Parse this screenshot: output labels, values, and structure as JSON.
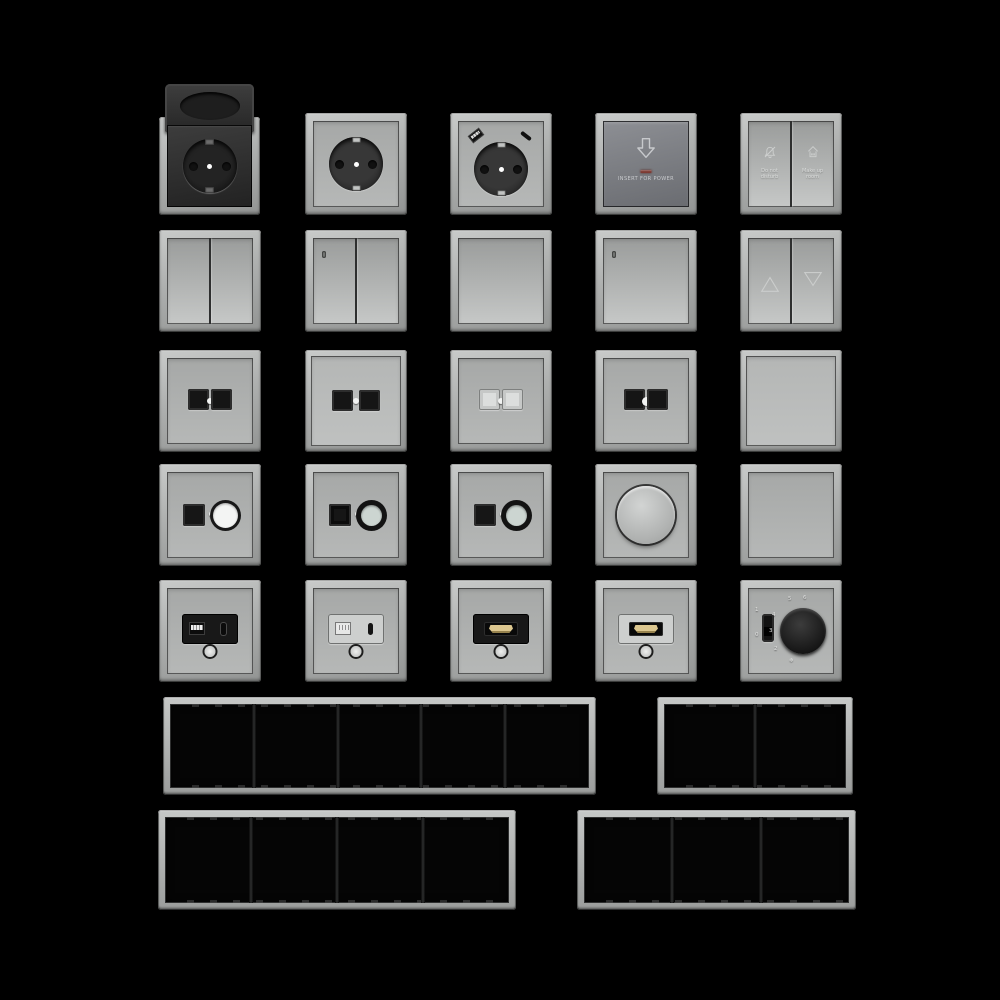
{
  "page": {
    "background": "#000000",
    "description": "Product sheet of modular wall switches, sockets and cover frames rendered on black"
  },
  "palette": {
    "frame_gray": "#b0b2b1",
    "plate_gray": "#aeb0af",
    "dark_plate": "#74767b",
    "insert_black": "#1a1a1a",
    "hdmi_gold": "#dcc78f",
    "led_red": "#7d3a33",
    "center_dot": "#ffffff"
  },
  "grid": {
    "rows": [
      {
        "items": [
          "schuko-socket-hinged-cover-black",
          "schuko-socket-gray",
          "schuko-socket-usb-charger",
          "keycard-power-switch",
          "hotel-service-double-switch"
        ]
      },
      {
        "items": [
          "double-rocker-switch",
          "double-rocker-switch-led",
          "single-rocker-switch",
          "single-rocker-switch-led",
          "blind-control-switch"
        ]
      },
      {
        "items": [
          "dual-data-socket-black",
          "dual-data-socket-black-raised",
          "dual-data-socket-white",
          "dual-data-socket-black-indicator",
          "blank-rocker-plate"
        ]
      },
      {
        "items": [
          "data-coax-combo-white-ring",
          "data-coax-combo-black-ring",
          "data-coax-combo-black-ring-2",
          "rotary-dimmer",
          "blank-cover-plate"
        ]
      },
      {
        "items": [
          "usb-a-c-charger-black",
          "usb-a-c-charger-gray",
          "hdmi-socket-black",
          "hdmi-socket-gray",
          "thermostat-dial"
        ]
      }
    ]
  },
  "keycard_switch": {
    "icon": "arrow-down-outline",
    "label": "INSERT FOR POWER",
    "led_color": "#7d3a33"
  },
  "hotel_switch": {
    "left": {
      "icon": "do-not-disturb-bell",
      "label_line1": "Do not",
      "label_line2": "disturb"
    },
    "right": {
      "icon": "make-up-room-brush",
      "label_line1": "Make up",
      "label_line2": "room"
    }
  },
  "thermostat": {
    "switch_on": "1",
    "switch_off": "0",
    "dial_labels": [
      "2",
      "3",
      "4",
      "5",
      "6"
    ],
    "frost_symbol": "❄"
  },
  "frames": [
    {
      "name": "frame-5-gang",
      "gangs": 5
    },
    {
      "name": "frame-2-gang",
      "gangs": 2
    },
    {
      "name": "frame-4-gang",
      "gangs": 4
    },
    {
      "name": "frame-3-gang",
      "gangs": 3
    }
  ]
}
